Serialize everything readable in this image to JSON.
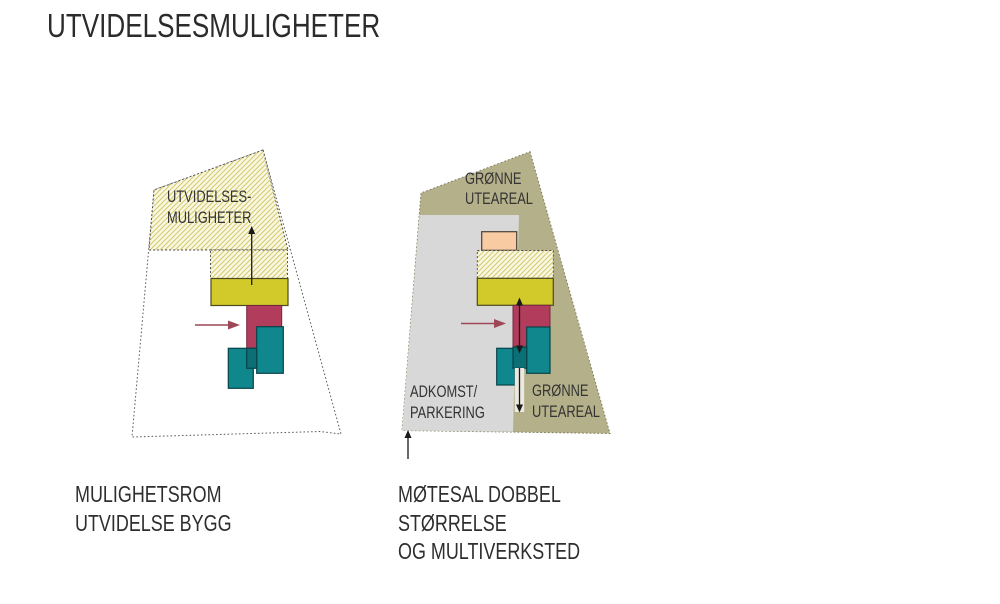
{
  "title": "UTVIDELSESMULIGHETER",
  "colors": {
    "site_fill_left": "#ffffff",
    "olive": "#b4b18a",
    "gray": "#d8d8d8",
    "peach": "#f9cba2",
    "yellow": "#d2c92b",
    "red": "#b13c5c",
    "teal": "#0f878c",
    "teal_dark": "#0b6f75",
    "hatch_bg": "#faf8e4",
    "hatch_line": "#d5cb6d",
    "arrow_black": "#1a1a1a",
    "arrow_red": "#9e4757",
    "arrow_halo": "#eceae0"
  },
  "left": {
    "area_label_line1": "UTVIDELSES-",
    "area_label_line2": "MULIGHETER",
    "caption_line1": "MULIGHETSROM",
    "caption_line2": "UTVIDELSE BYGG"
  },
  "right": {
    "green_top_line1": "GRØNNE",
    "green_top_line2": "UTEAREAL",
    "parking_line1": "ADKOMST/",
    "parking_line2": "PARKERING",
    "green_bottom_line1": "GRØNNE",
    "green_bottom_line2": "UTEAREAL",
    "caption_line1": "MØTESAL DOBBEL",
    "caption_line2": "STØRRELSE",
    "caption_line3": "OG MULTIVERKSTED"
  }
}
